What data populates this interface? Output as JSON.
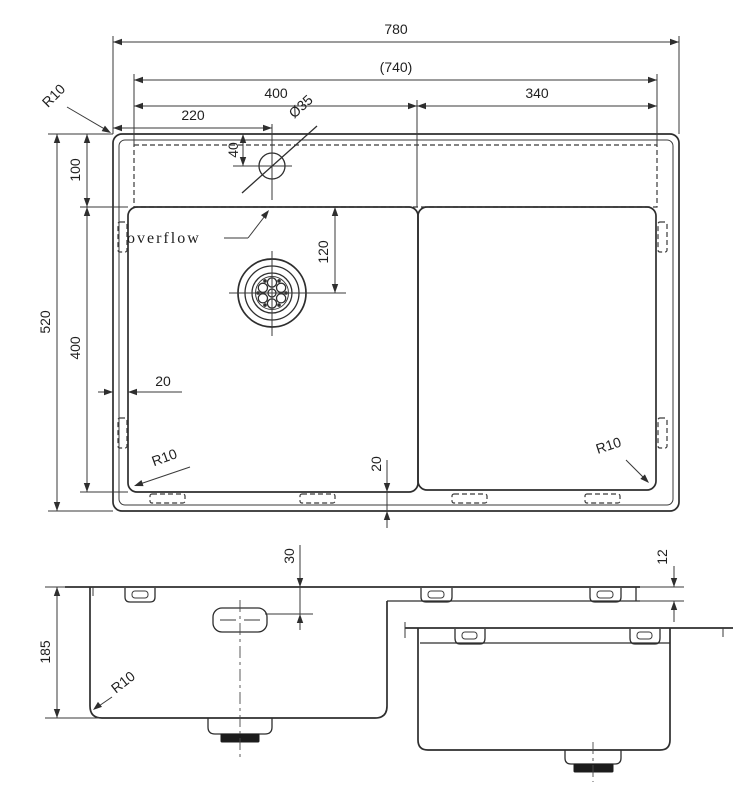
{
  "drawing": {
    "background": "#ffffff",
    "line_color": "#2e2e2e"
  },
  "top_view": {
    "labels": {
      "overall_width": "780",
      "rim_width_ref": "(740)",
      "bowl_width": "400",
      "right_section_width": "340",
      "faucet_offset": "220",
      "faucet_hole_diameter": "Ø35",
      "faucet_hole_offset": "40",
      "deck_depth": "100",
      "overall_depth": "520",
      "bowl_depth": "400",
      "drain_offset": "120",
      "side_gap": "20",
      "bottom_gap": "20",
      "corner_radius_outer": "R10",
      "corner_radius_bowl": "R10",
      "corner_radius_right": "R10",
      "overflow_label": "overflow"
    }
  },
  "front_view": {
    "labels": {
      "bowl_height": "185",
      "overflow_drop": "30",
      "rim_thickness": "12",
      "bottom_radius": "R10"
    }
  }
}
